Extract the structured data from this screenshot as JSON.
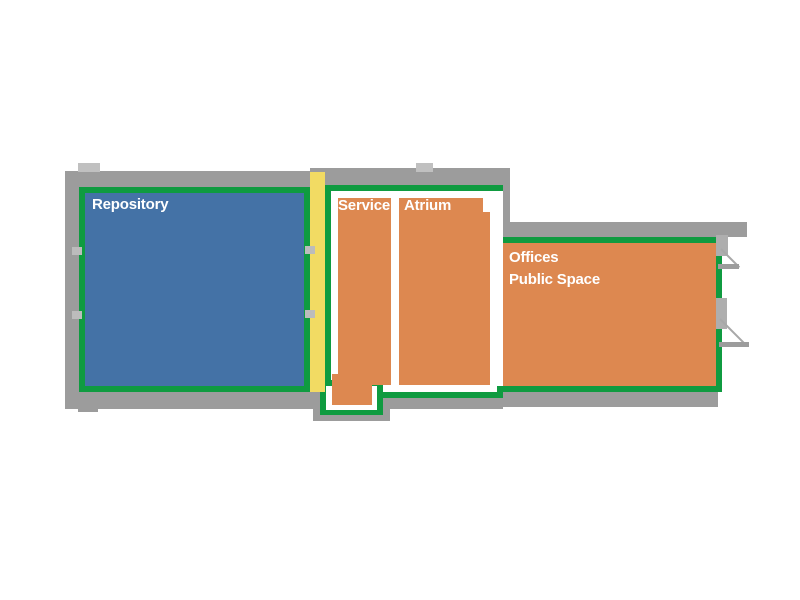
{
  "diagram": {
    "type": "building-floor-plan",
    "rooms": {
      "repository": {
        "label": "Repository",
        "fill": "#4472a6"
      },
      "service": {
        "label": "Service",
        "fill": "#dd8850"
      },
      "atrium": {
        "label": "Atrium",
        "fill": "#dd8850"
      },
      "offices": {
        "label": "Offices",
        "label2": "Public Space",
        "fill": "#dd8850"
      }
    },
    "colors": {
      "wall_gray": "#9c9c9c",
      "wall_light_gray": "#c0c0c0",
      "outline_green": "#0f9b40",
      "corridor_yellow": "#f2db63",
      "room_border_white": "#ffffff",
      "label_text": "#ffffff",
      "background": "#ffffff"
    },
    "features": {
      "door_openings_right_wall": 2,
      "corridor_between": "Repository and Service"
    }
  }
}
